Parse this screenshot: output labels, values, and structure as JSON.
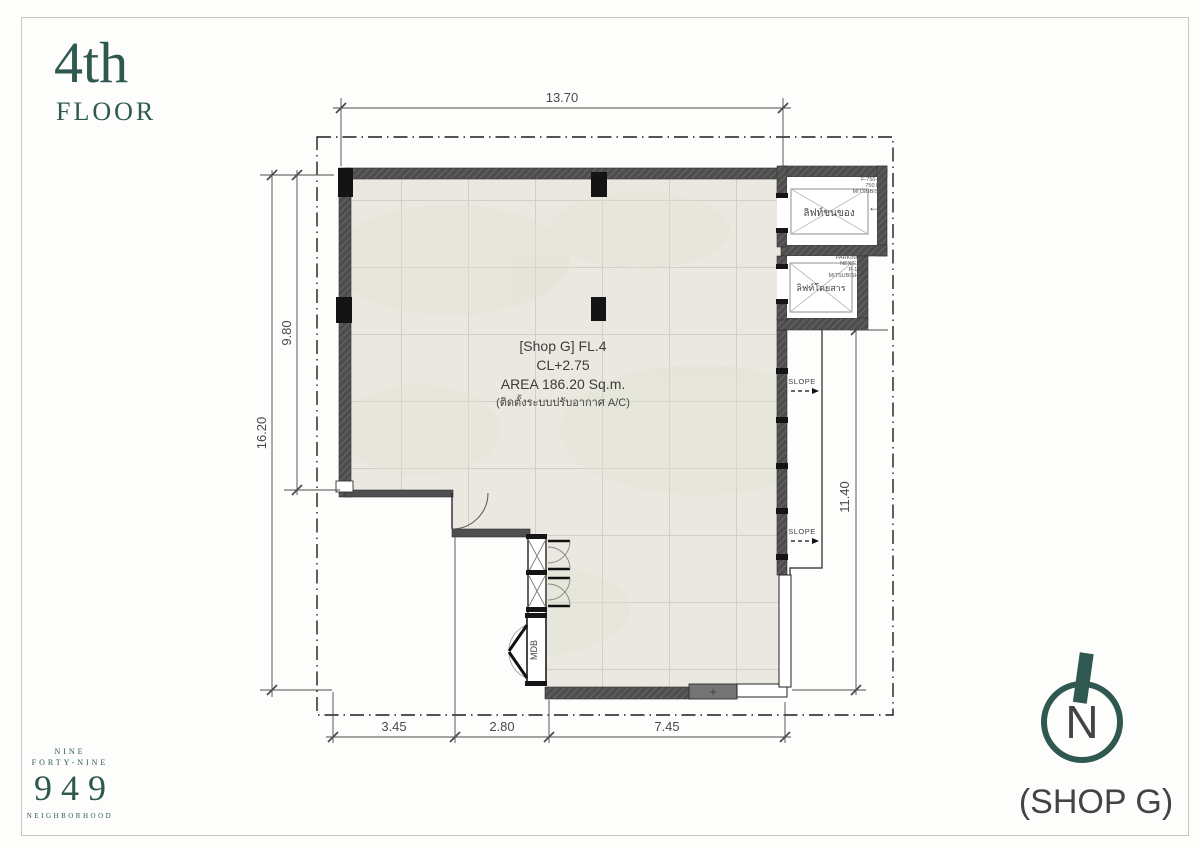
{
  "floor": {
    "title": "4th",
    "subtitle": "FLOOR"
  },
  "brand": {
    "top": "NINE",
    "mid": "FORTY-NINE",
    "number": "949",
    "bottom": "NEIGHBORHOOD"
  },
  "unit": {
    "line1": "[Shop G] FL.4",
    "line2": "CL+2.75",
    "line3": "AREA 186.20 Sq.m.",
    "line4": "(ติดตั้งระบบปรับอากาศ A/C)"
  },
  "dimensions": {
    "top": "13.70",
    "left_outer": "16.20",
    "left_inner": "9.80",
    "right": "11.40",
    "bottom_left": "3.45",
    "bottom_mid": "2.80",
    "bottom_right": "7.45"
  },
  "lifts": {
    "service": {
      "name": "ลิฟท์ขนของ",
      "spec1": "SERVICE",
      "spec2": "F-750-2S",
      "spec3": "750 KG",
      "spec4": "MITSUBISHI",
      "direction_arrow": "←"
    },
    "passenger": {
      "name": "ลิฟท์โดยสาร",
      "spec1": "PARKING",
      "spec2": "NEXIEZ",
      "spec3": "P-11",
      "spec4": "MITSUBISHI"
    }
  },
  "annotations": {
    "slope": "SLOPE",
    "mdb": "MDB",
    "wall_plus": "+"
  },
  "compass": {
    "letter": "N"
  },
  "footer": {
    "shop_label": "(SHOP G)"
  },
  "colors": {
    "brand_teal": "#2e5850",
    "wall_gray": "#4e4e4e",
    "floor_fill": "#eae8e0"
  }
}
